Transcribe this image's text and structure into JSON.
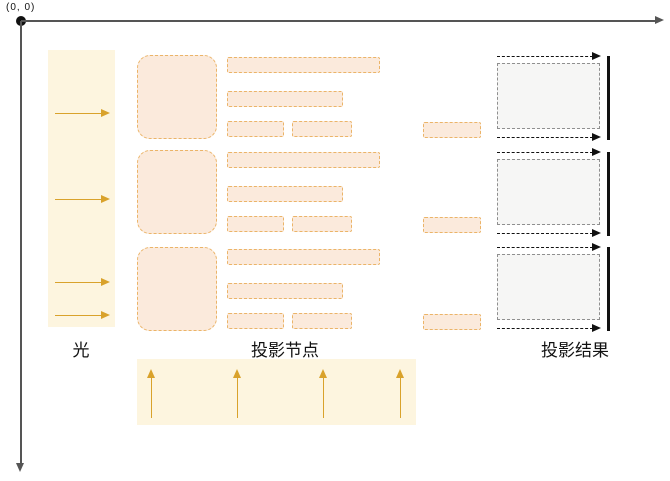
{
  "axes": {
    "origin_label": "(0, 0)"
  },
  "sections": {
    "light": {
      "label": "光",
      "ray_count": 4
    },
    "nodes": {
      "label": "投影节点",
      "group_count": 3
    },
    "results": {
      "label": "投影结果",
      "group_count": 3
    },
    "bottom_light": {
      "ray_count": 4
    }
  },
  "colors": {
    "band_fill": "#FDF5DF",
    "gold": "#D9A22B",
    "node_fill": "#FBEADC",
    "node_border": "#EBB468",
    "result_fill": "#F6F6F5",
    "result_border": "#8F8F8F",
    "ink": "#111111",
    "axis": "#555555"
  }
}
